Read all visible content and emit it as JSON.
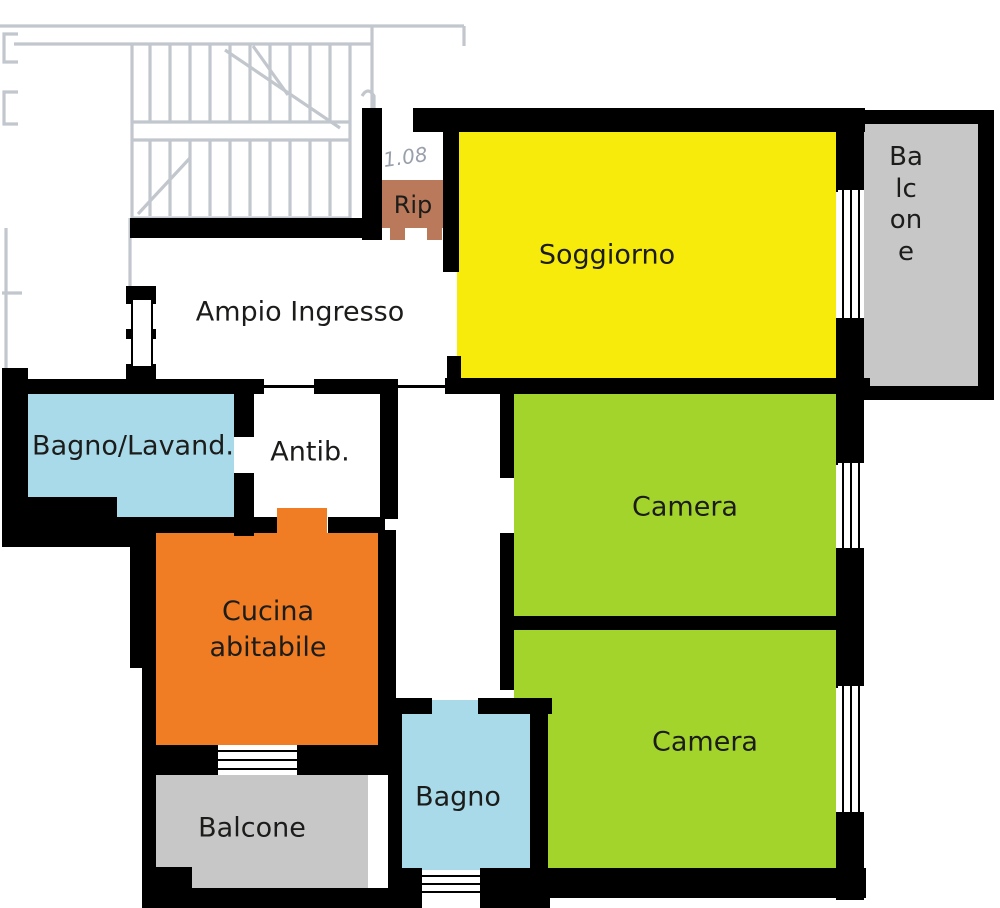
{
  "rooms": {
    "soggiorno": {
      "label": "Soggiorno",
      "color": "#f7eb0c"
    },
    "balcone_destra": {
      "label": "Balcone",
      "color": "#c7c7c7"
    },
    "rip": {
      "label": "Rip",
      "color": "#b9795a"
    },
    "ampio_ingresso": {
      "label": "Ampio Ingresso",
      "color": "#ffffff"
    },
    "bagno_lavanderia": {
      "label": "Bagno/Lavand.",
      "color": "#a8daea"
    },
    "antibagno": {
      "label": "Antib.",
      "color": "#ffffff"
    },
    "camera_1": {
      "label": "Camera",
      "color": "#a3d42c"
    },
    "camera_2": {
      "label": "Camera",
      "color": "#a3d42c"
    },
    "cucina": {
      "label": "Cucina abitabile",
      "color": "#f07c24"
    },
    "bagno": {
      "label": "Bagno",
      "color": "#a8daea"
    },
    "balcone_basso": {
      "label": "Balcone",
      "color": "#c7c7c7"
    }
  },
  "annotations": {
    "measure": "1.08"
  },
  "colors": {
    "wall": "#000000",
    "sketch_line": "#a9aeb8",
    "label_text": "#1c1c1a"
  }
}
